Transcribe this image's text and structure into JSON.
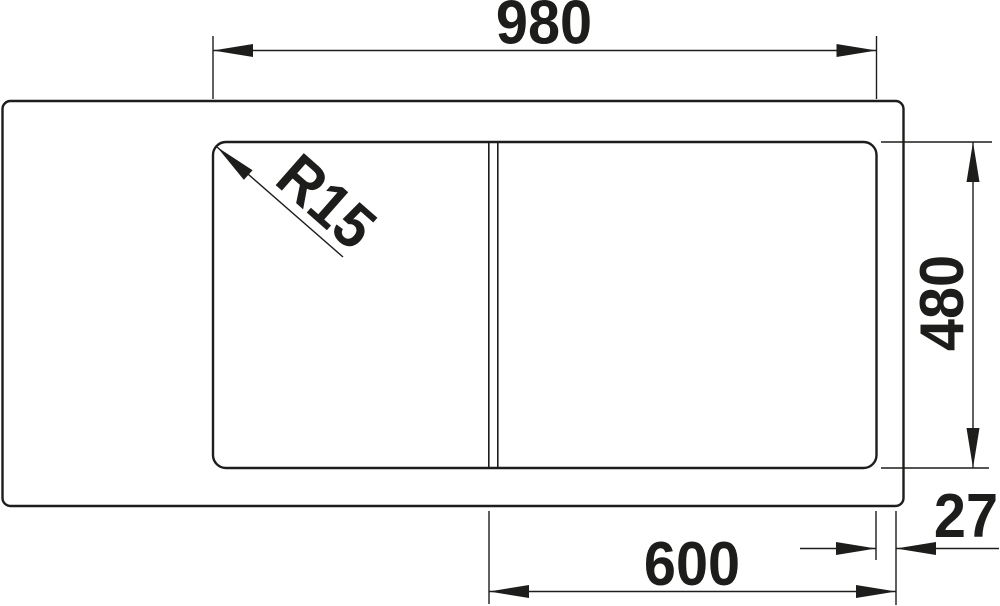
{
  "drawing": {
    "type": "sink-top-view-dimension-drawing",
    "background": "#ffffff",
    "line_color": "#1d1d1b"
  },
  "dimensions": {
    "overall_width": "980",
    "depth": "480",
    "bowl_width": "600",
    "rim_offset": "27",
    "corner_radius": "R15"
  }
}
